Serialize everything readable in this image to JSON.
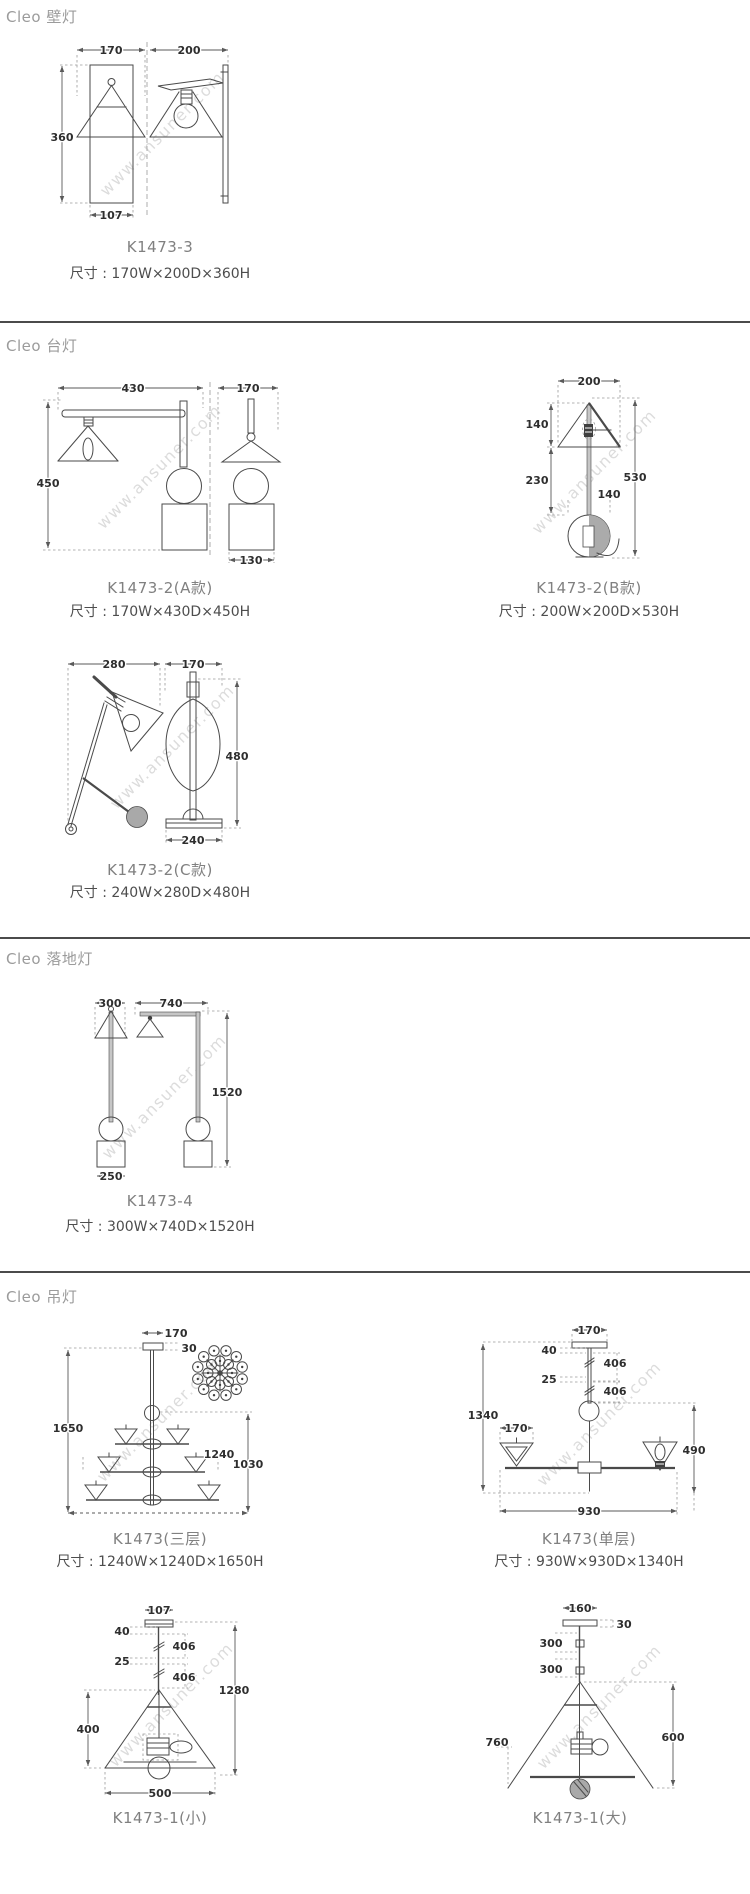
{
  "watermark": "www.ansuner.com",
  "colors": {
    "background": "#ffffff",
    "line": "#4a4a4a",
    "dimension_text": "#2e2e2e",
    "section_title": "#9b9b9b",
    "product_code": "#808080",
    "size_text": "#4d4d4d",
    "divider": "#4b4b4b",
    "watermark": "#dcdcdc"
  },
  "sections": {
    "wall": {
      "title": "Cleo 壁灯",
      "product": {
        "code": "K1473-3",
        "size": "尺寸 : 170W×200D×360H",
        "dims": {
          "shade_w": "170",
          "depth": "200",
          "height": "360",
          "plate_w": "107"
        }
      }
    },
    "table": {
      "title": "Cleo 台灯",
      "a": {
        "code": "K1473-2(A款)",
        "size": "尺寸 : 170W×430D×450H",
        "dims": {
          "arm": "430",
          "shade_w": "170",
          "height": "450",
          "base_w": "130"
        }
      },
      "b": {
        "code": "K1473-2(B款)",
        "size": "尺寸 : 200W×200D×530H",
        "dims": {
          "shade_w": "200",
          "shade_h": "140",
          "stem": "230",
          "height": "530",
          "ball": "140"
        }
      },
      "c": {
        "code": "K1473-2(C款)",
        "size": "尺寸 : 240W×280D×480H",
        "dims": {
          "depth": "280",
          "shade_w": "170",
          "height": "480",
          "base_w": "240"
        }
      }
    },
    "floor": {
      "title": "Cleo 落地灯",
      "product": {
        "code": "K1473-4",
        "size": "尺寸 : 300W×740D×1520H",
        "dims": {
          "shade_w": "300",
          "arm": "740",
          "height": "1520",
          "base_w": "250"
        }
      }
    },
    "pendant": {
      "title": "Cleo 吊灯",
      "tri": {
        "code": "K1473(三层)",
        "size": "尺寸 : 1240W×1240D×1650H",
        "dims": {
          "canopy_w": "170",
          "canopy_h": "30",
          "height": "1650",
          "width": "1240",
          "body_h": "1030"
        }
      },
      "single": {
        "code": "K1473(单层)",
        "size": "尺寸 : 930W×930D×1340H",
        "dims": {
          "canopy_w": "170",
          "gap1": "40",
          "rod1": "406",
          "gap2": "25",
          "rod2": "406",
          "height": "1340",
          "shade_w": "170",
          "body_h": "490",
          "width": "930"
        }
      },
      "small": {
        "code": "K1473-1(小)",
        "dims": {
          "canopy_w": "107",
          "gap1": "40",
          "rod1": "406",
          "gap2": "25",
          "rod2": "406",
          "height": "1280",
          "shade_h": "400",
          "shade_w": "500"
        }
      },
      "large": {
        "code": "K1473-1(大)",
        "dims": {
          "canopy_w": "160",
          "canopy_h": "30",
          "rod1": "300",
          "rod2": "300",
          "shade_w": "760",
          "shade_h": "600"
        }
      }
    }
  }
}
